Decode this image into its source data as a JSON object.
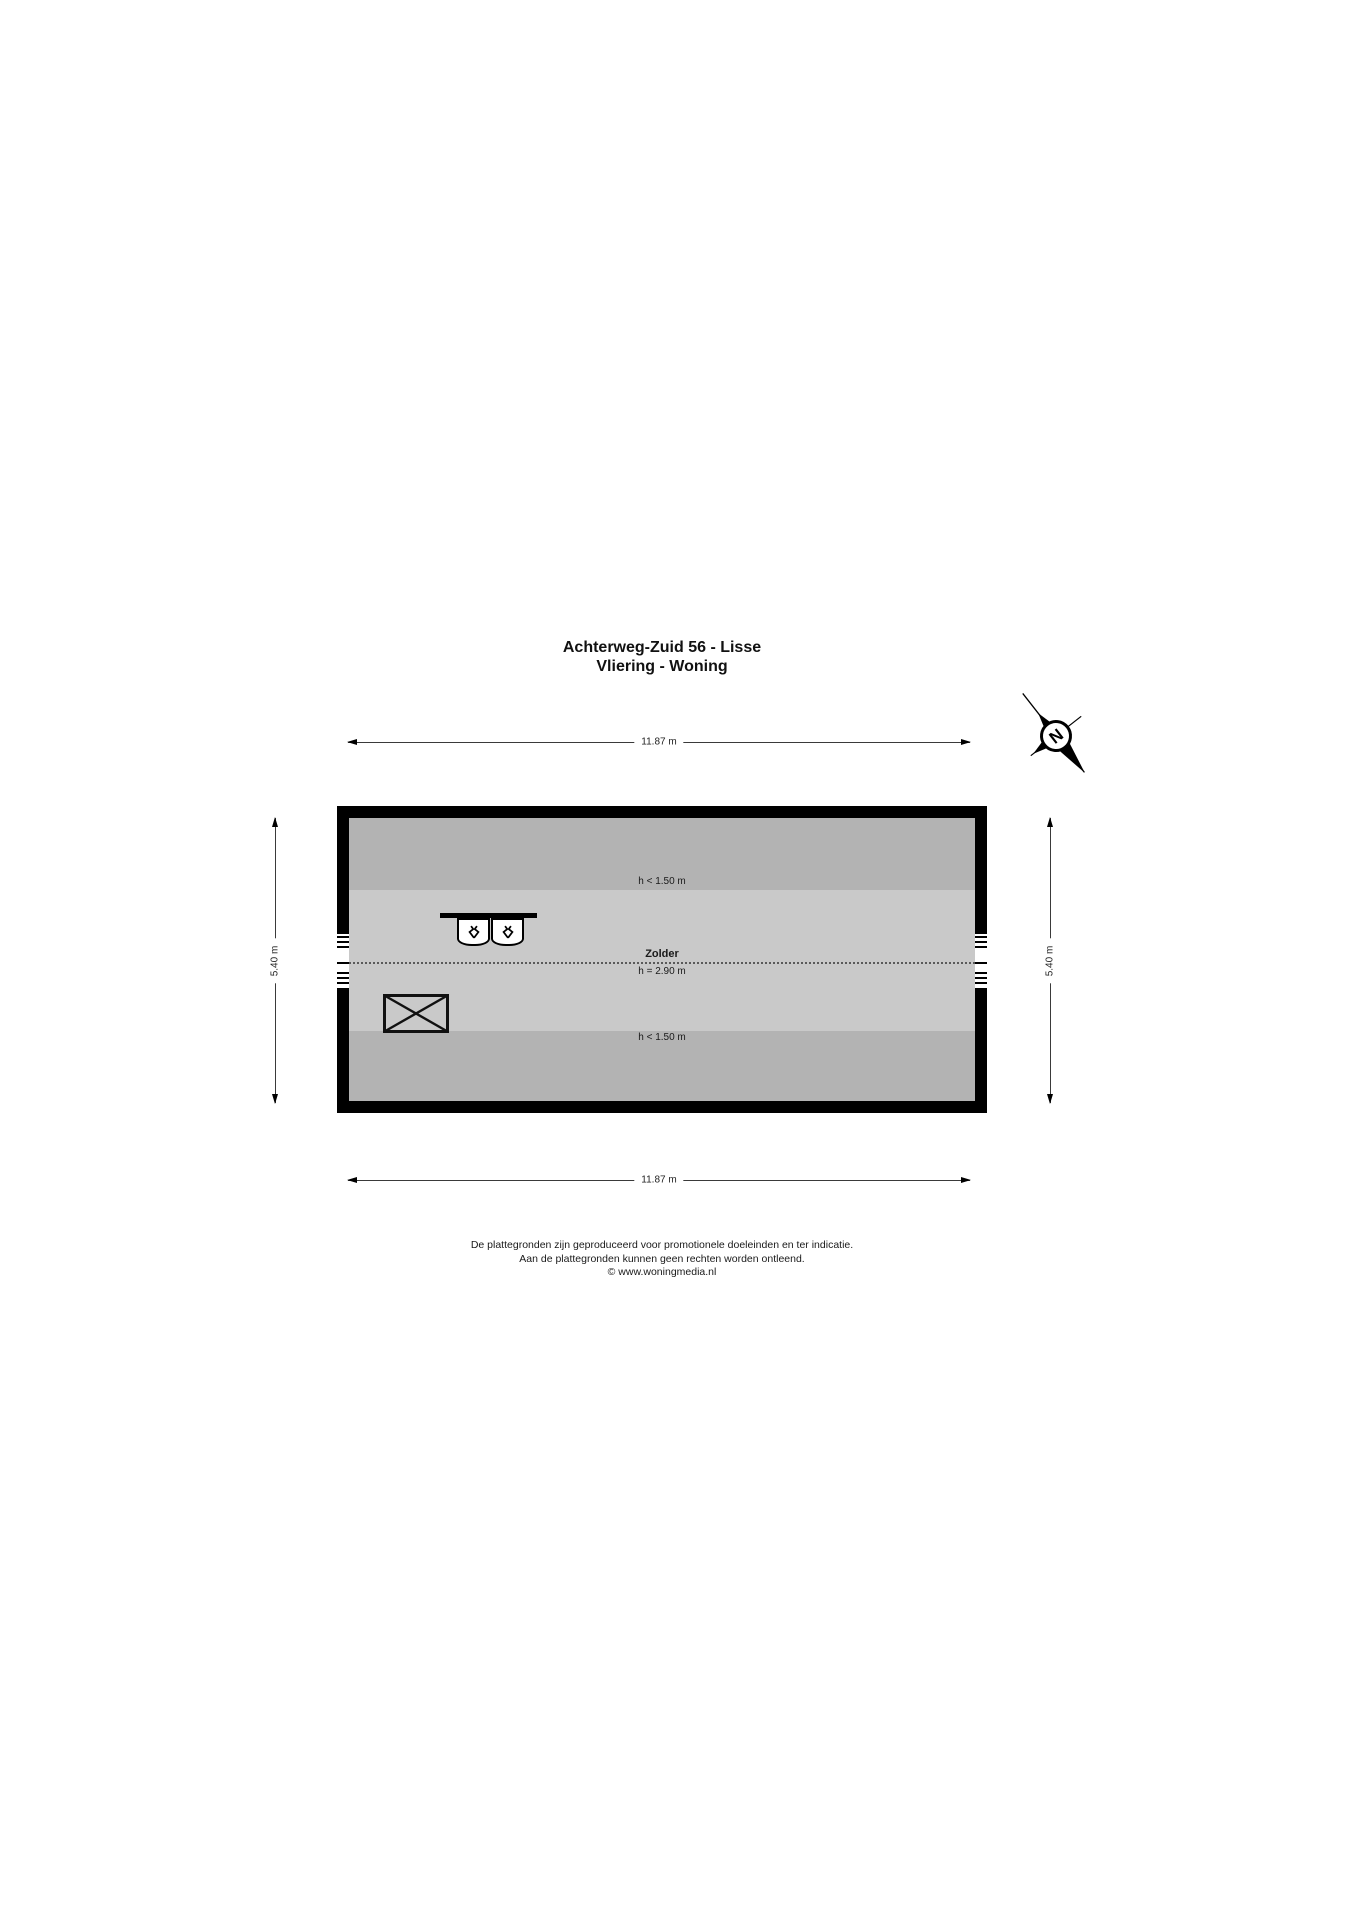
{
  "title": {
    "line1": "Achterweg-Zuid 56 - Lisse",
    "line2": "Vliering - Woning"
  },
  "compass": {
    "letter": "N"
  },
  "dimensions": {
    "top": "11.87 m",
    "bottom": "11.87 m",
    "left": "5.40 m",
    "right": "5.40 m"
  },
  "floorplan": {
    "zones": {
      "top_low": "h < 1.50 m",
      "room_name": "Zolder",
      "room_height": "h = 2.90 m",
      "bottom_low": "h < 1.50 m"
    },
    "colors": {
      "wall": "#000000",
      "low_zone": "#b3b3b3",
      "high_zone": "#c9c9c9"
    }
  },
  "footer": {
    "line1": "De plattegronden zijn geproduceerd voor promotionele doeleinden en ter indicatie.",
    "line2": "Aan de plattegronden kunnen geen rechten worden ontleend.",
    "line3": "© www.woningmedia.nl"
  }
}
